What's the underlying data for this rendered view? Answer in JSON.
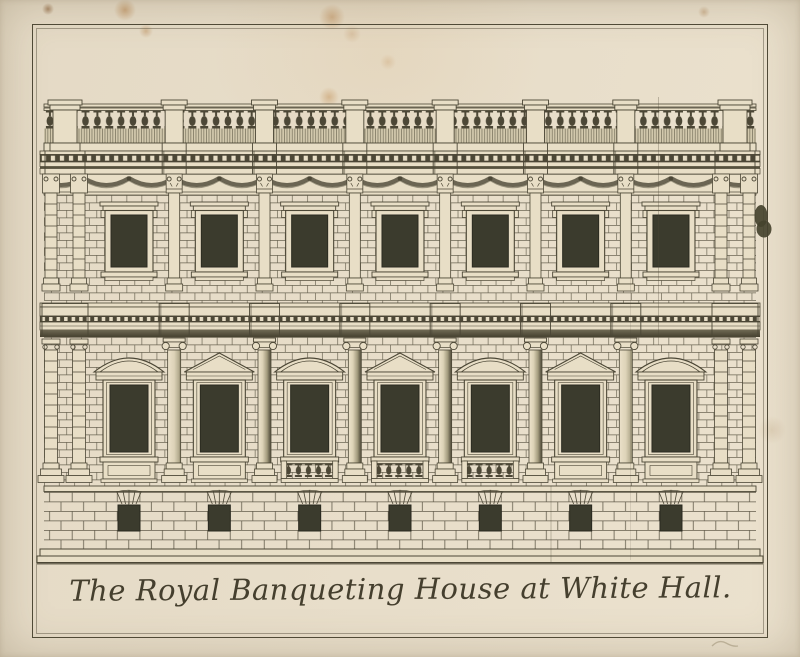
{
  "artwork": {
    "caption": "The Royal Banqueting House at White Hall.",
    "bay_count": 7,
    "basement_window_count": 7,
    "bays": [
      {
        "pediment": "segmental",
        "apron": "panel"
      },
      {
        "pediment": "triangular",
        "apron": "panel"
      },
      {
        "pediment": "segmental",
        "apron": "balustrade"
      },
      {
        "pediment": "triangular",
        "apron": "balustrade"
      },
      {
        "pediment": "segmental",
        "apron": "balustrade"
      },
      {
        "pediment": "triangular",
        "apron": "panel"
      },
      {
        "pediment": "segmental",
        "apron": "panel"
      }
    ],
    "colors": {
      "paper": "#eae0cc",
      "plate_paper": "#e8dec6",
      "ink": "#4c4736",
      "window_glass": "#3b3b2d",
      "stain_rust": "#b9935f"
    }
  }
}
